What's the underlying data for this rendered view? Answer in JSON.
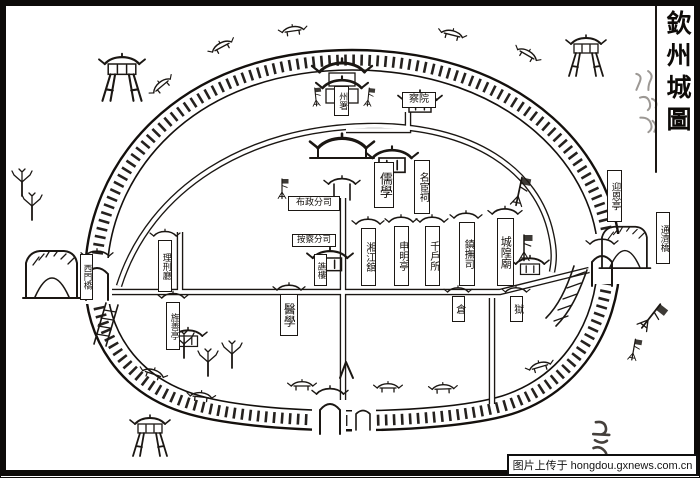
{
  "map": {
    "title": "欽州城圖",
    "labels": {
      "zhoushu": "州署",
      "chayuan": "察院",
      "ruxue": "儒學",
      "minghuanci": "名宦祠",
      "buzhengfensi": "布政分司",
      "anchafensi": "按察分司",
      "qiaolou": "譙樓",
      "xiangjiangguan": "湘江舘",
      "shenmingting": "申明亭",
      "qianhusuo": "千戶所",
      "zhenfusi": "鎮撫司",
      "chenghuangmiao": "城隍廟",
      "lixingting": "理刑廳",
      "jingshanting": "旌善亭",
      "yixue": "醫學",
      "cang": "倉",
      "yu": "獄",
      "ximenqiao": "西門橋",
      "yingenting": "迎恩亭",
      "tongjiqiao": "通濟橋"
    }
  },
  "watermark": {
    "text": "图片上传于 hongdou.gxnews.com.cn"
  },
  "colors": {
    "ink": "#1b1713",
    "paper": "#ffffff"
  }
}
